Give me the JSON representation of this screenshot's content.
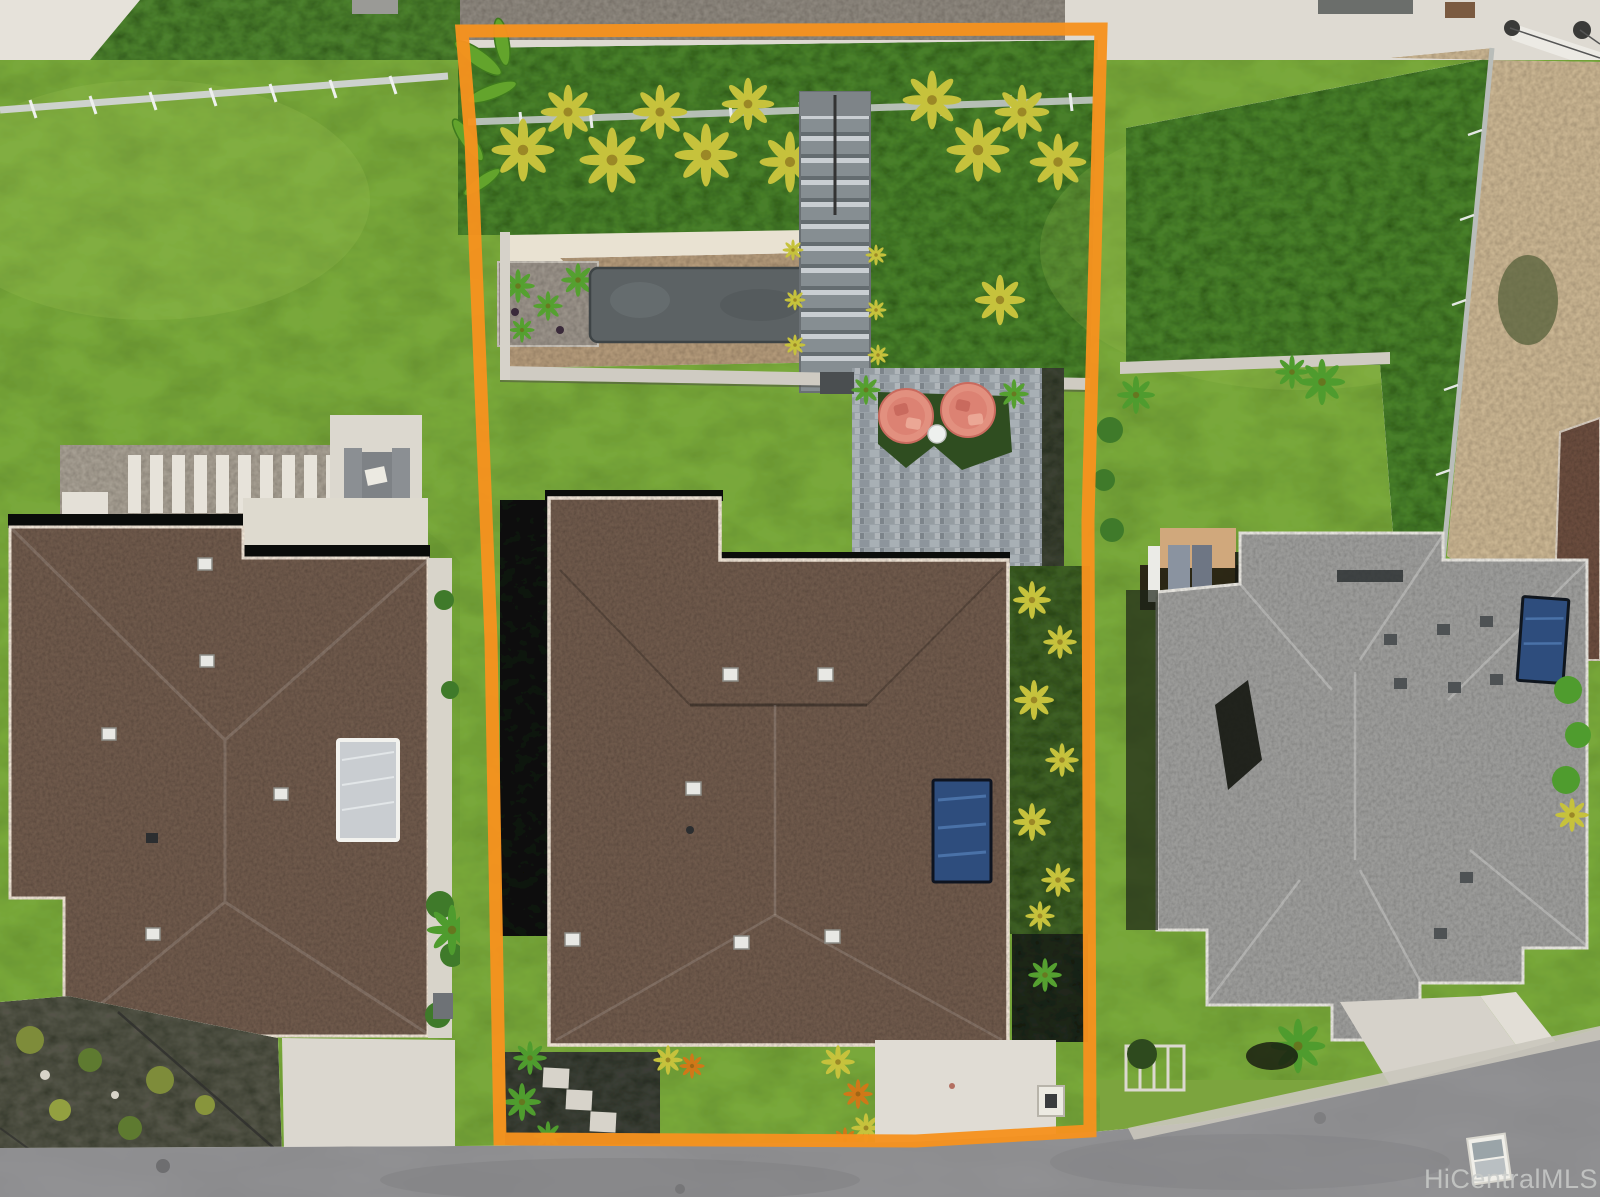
{
  "image": {
    "width": 1600,
    "height": 1197,
    "kind": "aerial-drone-real-estate-photo"
  },
  "watermark": {
    "text": "HiCentralMLS"
  },
  "boundary": {
    "label": "subject-property-outline",
    "style": "thick-orange-polygon"
  },
  "colors": {
    "lawn": "#79a83c",
    "lawnLight": "#93bd4e",
    "groundcover": "#4a7f2c",
    "palmYellow": "#c6c23c",
    "fernGreen": "#55a030",
    "roofBrown": "#6e5c50",
    "roofGray": "#9b9b99",
    "neighborRoof": "#6a4f42",
    "road": "#919193",
    "concrete": "#dedad2",
    "sand": "#e9e2d2",
    "gravel": "#b39b7c",
    "darkGravel": "#8d8880",
    "dirt": "#c9b694",
    "boundary": "#F6921E",
    "watermark": "#c9cbc9",
    "chairPink": "#e2907f",
    "solarBlue": "#2e4d7d",
    "solarSilver": "#c9cdd1",
    "shadow": "#111310",
    "paver": "#9aa2a8"
  },
  "scene": {
    "lots": [
      {
        "id": "left-lot",
        "features": [
          "back-lawn",
          "white-fence",
          "stepping-stone-path",
          "concrete-pad",
          "picnic-table",
          "bbq-grill",
          "brown-shingle-roof",
          "solar-water-heater",
          "roof-vents",
          "rock-garden",
          "front-driveway"
        ]
      },
      {
        "id": "subject-lot",
        "outlined": true,
        "features": [
          "top-fence",
          "tropical-hedge",
          "banana-plants",
          "garden-stairs",
          "sand-garden",
          "gravel-bed",
          "stone-planter",
          "planter-bed",
          "retaining-wall",
          "back-lawn",
          "paver-patio",
          "egg-chair",
          "egg-chair",
          "side-table",
          "putting-mat",
          "bench",
          "brown-shingle-roof",
          "solar-panel",
          "roof-vents",
          "croton-hedge",
          "lava-rock-bed",
          "stepping-stones",
          "front-lawn",
          "driveway",
          "utility-box"
        ]
      },
      {
        "id": "right-lot",
        "features": [
          "groundcover-slope",
          "dirt-slope",
          "side-fence",
          "back-deck",
          "patio-furniture",
          "gray-shingle-roof",
          "solar-panel",
          "roof-vents",
          "neighbor-roof-edge",
          "lawn",
          "tropical-plants",
          "hedge",
          "driveway",
          "trellis"
        ]
      }
    ],
    "road": {
      "position": "bottom",
      "features": [
        "curb-gutter",
        "manhole",
        "utility-marker",
        "power-lines"
      ]
    }
  }
}
